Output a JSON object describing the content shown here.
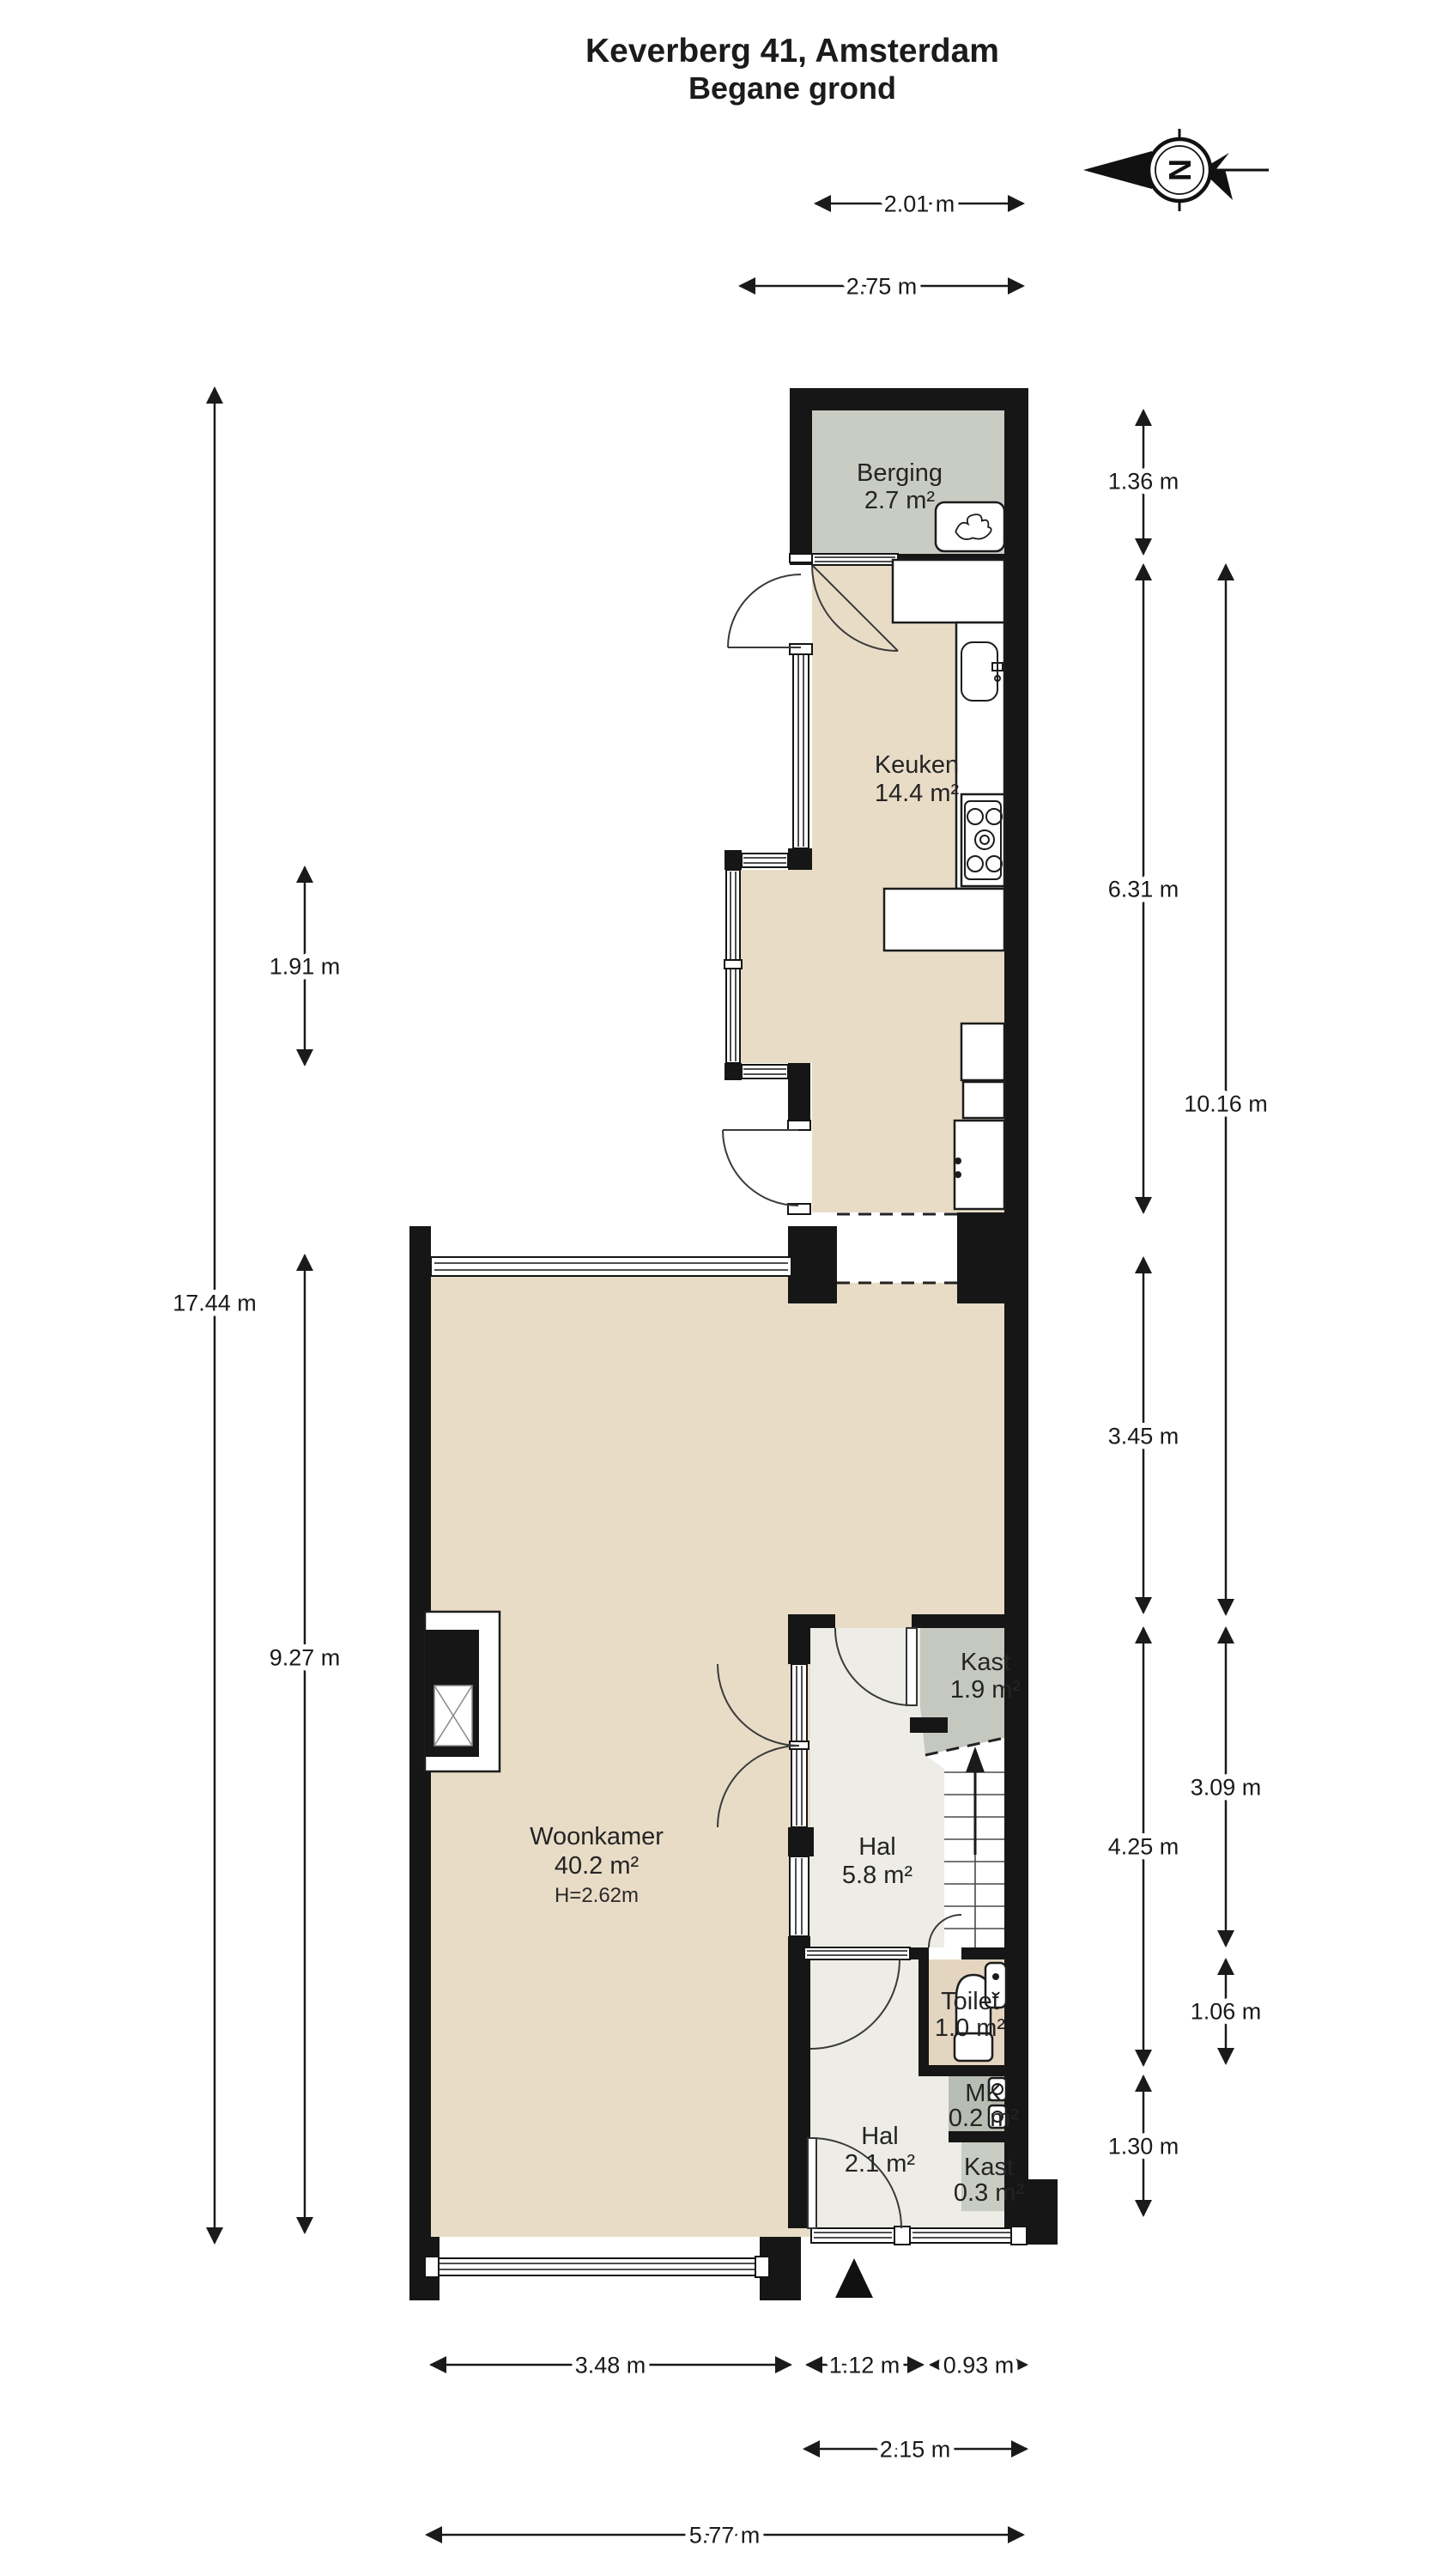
{
  "title": {
    "line1": "Keverberg 41, Amsterdam",
    "line2": "Begane grond"
  },
  "compass": {
    "letter": "N"
  },
  "rooms": [
    {
      "id": "berging",
      "name": "Berging",
      "area": "2.7 m²"
    },
    {
      "id": "keuken",
      "name": "Keuken",
      "area": "14.4 m²"
    },
    {
      "id": "woonkamer",
      "name": "Woonkamer",
      "area": "40.2 m²",
      "height": "H=2.62m"
    },
    {
      "id": "kast",
      "name": "Kast",
      "area": "1.9 m²"
    },
    {
      "id": "hal",
      "name": "Hal",
      "area": "5.8 m²"
    },
    {
      "id": "toilet",
      "name": "Toilet",
      "area": "1.0 m²"
    },
    {
      "id": "mk",
      "name": "MK",
      "area": "0.2 m²"
    },
    {
      "id": "hal2",
      "name": "Hal",
      "area": "2.1 m²"
    },
    {
      "id": "kast2",
      "name": "Kast",
      "area": "0.3 m²"
    }
  ],
  "dimensions": {
    "berging_width": "2.01 m",
    "bay_to_right_width": "2.75 m",
    "berging_height": "1.36 m",
    "keuken_height": "6.31 m",
    "keuken_hal_height": "10.16 m",
    "bay_height": "1.91 m",
    "total_height": "17.44 m",
    "upper_woonkamer_height": "3.45 m",
    "woonkamer_height": "9.27 m",
    "hal_toilet_height": "4.25 m",
    "hal_height": "3.09 m",
    "toilet_height": "1.06 m",
    "lower_section_height": "1.30 m",
    "woonkamer_width": "3.48 m",
    "hal_width": "1.12 m",
    "toilet_width": "0.93 m",
    "entrance_width": "2.15 m",
    "total_width": "5.77 m"
  },
  "colors": {
    "wall": "#161616",
    "floor_beige": "#e8dcc6",
    "floor_berging": "#c9ccc3",
    "floor_hal": "#edece6",
    "floor_kast": "#c5c8bf",
    "floor_mk": "#b8bdb4",
    "floor_kast2": "#c8ccc2",
    "floor_toilet": "#e4d5c0"
  }
}
